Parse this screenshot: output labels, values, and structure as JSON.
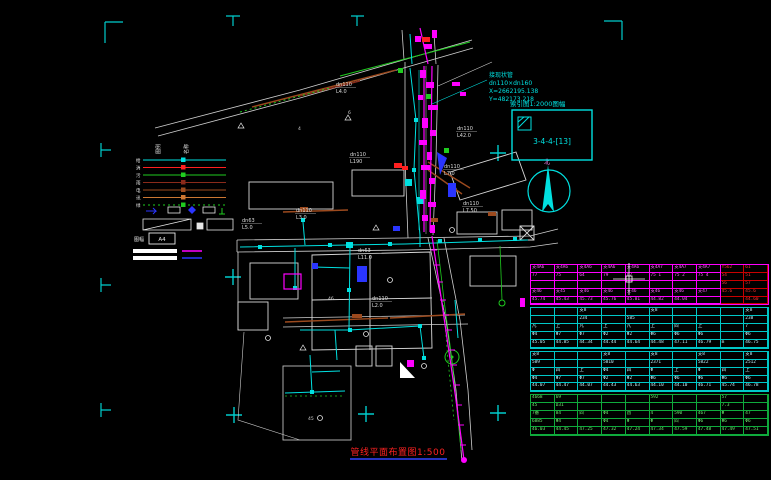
{
  "drawing": {
    "title": "管线平面布置图1:500",
    "north_label": "北",
    "index_box": {
      "label": "索引图1:2000图幅",
      "code": "3-4-4-[13]"
    },
    "annotation": {
      "l0": "接现状管",
      "l1": "dn110×dn160",
      "l2": "X=2662195.138",
      "l3": "Y=482173.218"
    },
    "colors": {
      "cyan": "#00e0e0",
      "magenta": "#ff00ff",
      "red": "#ff2020",
      "green": "#1fcc1f",
      "brown": "#9c4a1e",
      "blue": "#2a35ff",
      "white": "#e8e8e8",
      "grey": "#b9b9b9",
      "underline_blue": "#3344ff"
    },
    "pipe_labels": [
      {
        "size": "dn110",
        "len": "L3.0",
        "x": 296,
        "y": 212
      },
      {
        "size": "dn63",
        "len": "L5.0",
        "x": 242,
        "y": 222
      },
      {
        "size": "dn110",
        "len": "L42.0",
        "x": 457,
        "y": 130
      },
      {
        "size": "dn110",
        "len": "L7.0",
        "x": 444,
        "y": 168
      },
      {
        "size": "dn110",
        "len": "L7.50",
        "x": 463,
        "y": 205
      },
      {
        "size": "dn110",
        "len": "L190",
        "x": 350,
        "y": 156
      },
      {
        "size": "dn110",
        "len": "L4.0",
        "x": 336,
        "y": 86
      },
      {
        "size": "dn63",
        "len": "L11.0",
        "x": 358,
        "y": 252
      },
      {
        "size": "dn110",
        "len": "L2.0",
        "x": 372,
        "y": 300
      }
    ],
    "small_numbers": [
      {
        "t": "46",
        "x": 328,
        "y": 300
      },
      {
        "t": "45",
        "x": 308,
        "y": 420
      },
      {
        "t": "4",
        "x": 298,
        "y": 130
      },
      {
        "t": "6",
        "x": 348,
        "y": 114
      }
    ]
  },
  "legend": {
    "header_left": "图例",
    "header_right": "名称",
    "items": [
      {
        "label": "给",
        "color": "#00e0e0",
        "dash": false
      },
      {
        "label": "消",
        "color": "#ff2020",
        "dash": false
      },
      {
        "label": "污",
        "color": "#1fcc1f",
        "dash": false
      },
      {
        "label": "雨",
        "color": "#8a2a1a",
        "dash": false
      },
      {
        "label": "电",
        "color": "#9c4a1e",
        "dash": false
      },
      {
        "label": "讯",
        "color": "#cc7733",
        "dash": false
      },
      {
        "label": "绿",
        "color": "#1fcc1f",
        "dash": true
      }
    ],
    "scale_caption": "图幅",
    "scale_label": "A4"
  },
  "table": {
    "sections": [
      {
        "grid_color": "#ff00ff",
        "text_color": "#ff66ff",
        "red_cols": [
          8,
          9
        ],
        "rows": [
          [
            "支4A6",
            "支4A6",
            "支4A6",
            "支4A6",
            "支4A6",
            "支4A7",
            "支4A7",
            "支4A7",
            "Y562",
            "61"
          ],
          [
            "77",
            "75",
            "64",
            "79",
            "67",
            "75 1",
            "75 2",
            "75 4",
            "54",
            "51"
          ],
          [
            "",
            "",
            "",
            "",
            "",
            "",
            "",
            "",
            "56",
            "57"
          ],
          [
            "支46",
            "支45",
            "支46",
            "支46",
            "支46",
            "支46",
            "支46",
            "支47",
            "45.6",
            "45.6"
          ],
          [
            "45.74",
            "45.43",
            "45.73",
            "45.76",
            "45.81",
            "44.82",
            "44.04",
            "",
            "",
            "44.60"
          ]
        ]
      },
      {
        "grid_color": "#00c8c8",
        "text_color": "#bfeffa",
        "red_cols": [],
        "rows": [
          [
            "",
            "",
            "支8",
            "",
            "",
            "支8",
            "",
            "",
            "",
            "支8"
          ],
          [
            "",
            "",
            "234",
            "",
            "585",
            "",
            "",
            "",
            "",
            "238"
          ],
          [
            "凡",
            "上",
            "凡",
            "上",
            "凡",
            "上",
            "四",
            "上",
            "",
            "7"
          ],
          [
            "Φ4",
            "Φ7",
            "Φ7",
            "Φ2",
            "Φ2",
            "Φ6",
            "Φ6",
            "Φ6",
            "",
            "Φ6"
          ],
          [
            "45.05",
            "44.85",
            "44.34",
            "44.44",
            "44.64",
            "44.48",
            "47.11",
            "46.79",
            "m",
            "46.75"
          ]
        ]
      },
      {
        "grid_color": "#00c8c8",
        "text_color": "#bfeffa",
        "red_cols": [],
        "rows": [
          [
            "支8",
            "",
            "",
            "支8",
            "",
            "支8",
            "",
            "支8",
            "",
            "支8"
          ],
          [
            "589",
            "",
            "",
            "5810",
            "",
            "2371",
            "",
            "5822",
            "",
            "2512"
          ],
          [
            "Φ",
            "四",
            "上",
            "Φ4",
            "四",
            "Φ",
            "上",
            "Φ",
            "四",
            "上"
          ],
          [
            "Φ4",
            "Φ7",
            "Φ7",
            "Φ2",
            "Φ2",
            "Φ6",
            "Φ6",
            "Φ6",
            "Φ6",
            "Φ6"
          ],
          [
            "44.07",
            "44.47",
            "44.07",
            "44.43",
            "44.63",
            "44.10",
            "44.10",
            "46.71",
            "45.74",
            "46.78"
          ]
        ]
      },
      {
        "grid_color": "#0faa3c",
        "text_color": "#6fe86f",
        "red_cols": [],
        "rows": [
          [
            "4668",
            "69",
            "",
            "",
            "",
            "592",
            "",
            "",
            "57",
            ""
          ],
          [
            "45",
            "D31",
            "",
            "",
            "",
            "",
            "",
            "",
            "7.3",
            ""
          ],
          [
            "7番",
            "84",
            "四",
            "Φ4",
            "酉",
            "4",
            "590",
            "467",
            "Φ",
            "47"
          ],
          [
            "6885",
            "Φ4",
            "",
            "Φ4",
            "Φ",
            "Φ",
            "四",
            "Φ6",
            "Φ6",
            "Φ6"
          ],
          [
            "46.03",
            "44.45",
            "47.25",
            "47.32",
            "47.24",
            "47.34",
            "47.59",
            "47.48",
            "47.49",
            "47.51"
          ]
        ]
      }
    ]
  }
}
